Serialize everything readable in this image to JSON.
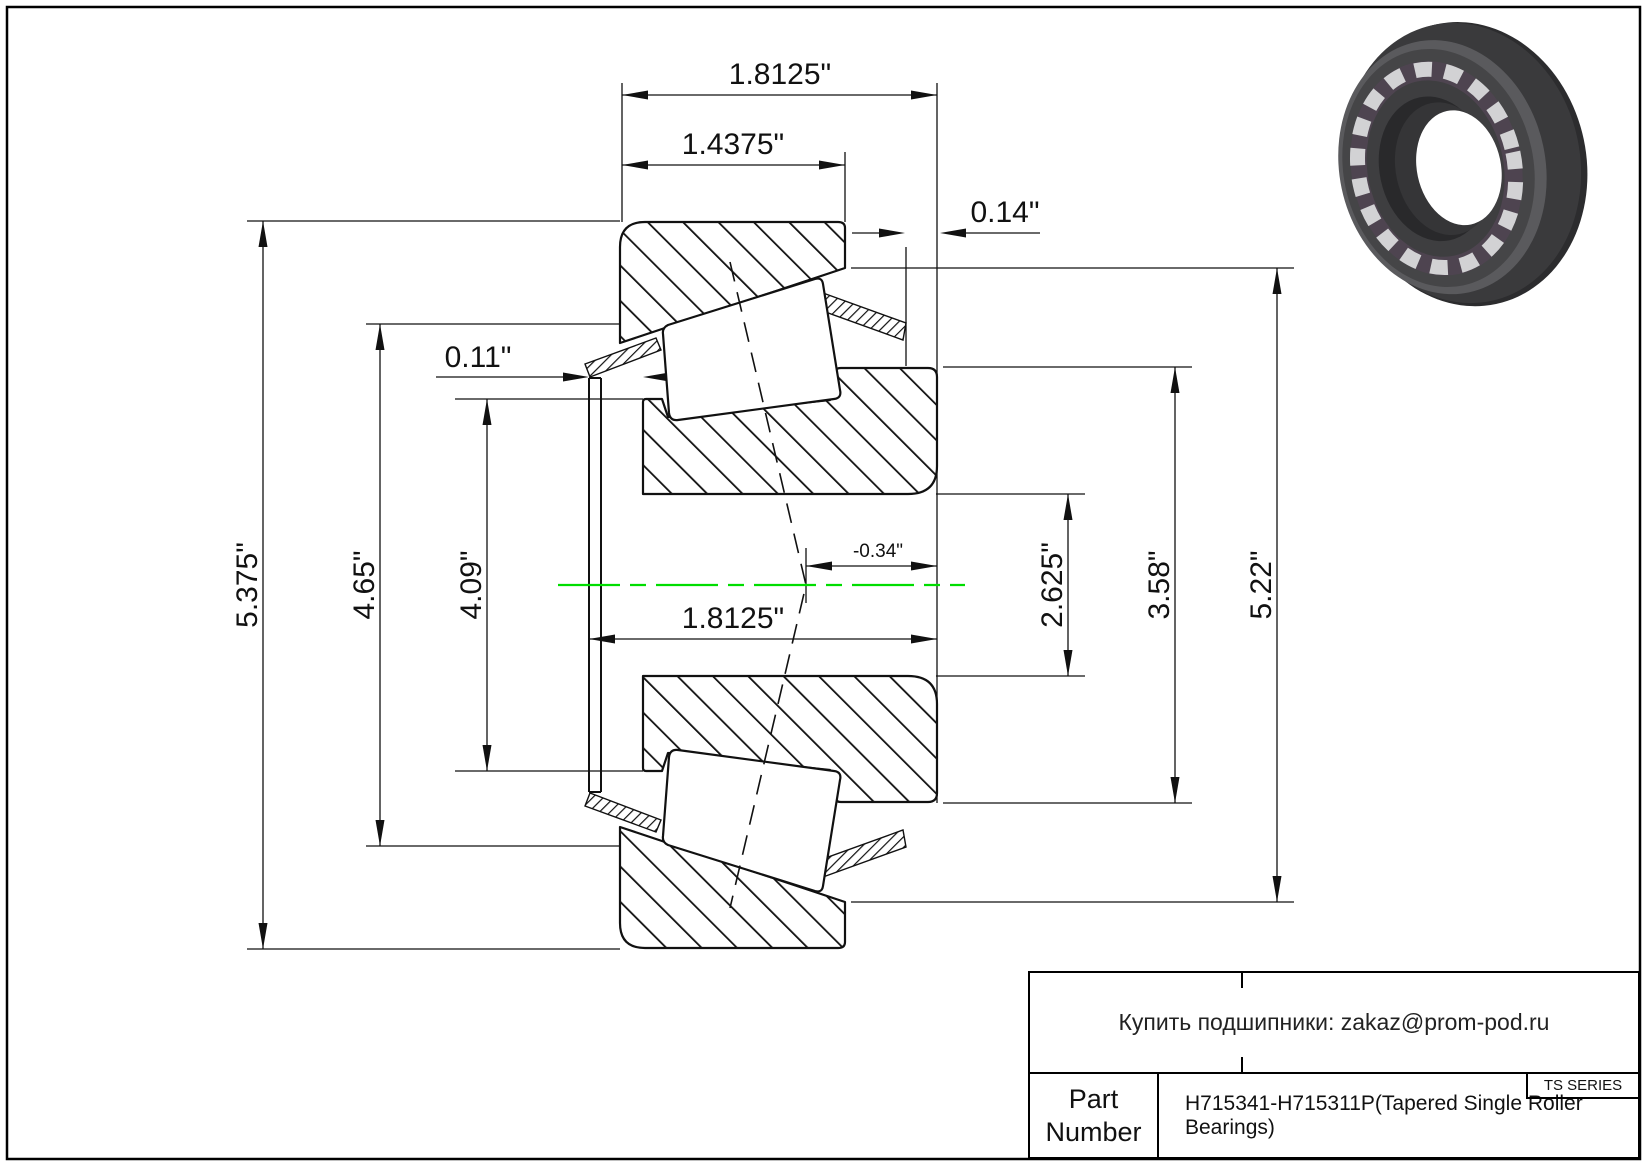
{
  "page": {
    "background": "#ffffff",
    "border_color": "#000000",
    "centerline_color": "#00dd00"
  },
  "drawing": {
    "description": "Tapered single roller bearing cross-section",
    "dims": {
      "overall_width": "1.8125\"",
      "cup_width": "1.4375\"",
      "cage_protrusion": "0.14\"",
      "front_standout": "0.11\"",
      "outer_dia": "5.375\"",
      "housing_dia": "4.65\"",
      "rib_dia": "4.09\"",
      "cone_width": "1.8125\"",
      "effective_center": "-0.34\"",
      "bore_dia": "2.625\"",
      "backing_dia": "3.58\"",
      "cup_front_dia": "5.22\""
    }
  },
  "title_block": {
    "contact": "Купить подшипники: zakaz@prom-pod.ru",
    "series": "TS SERIES",
    "part_label": "Part Number",
    "part_number": "H715341-H715311P(Tapered Single Roller Bearings)"
  }
}
